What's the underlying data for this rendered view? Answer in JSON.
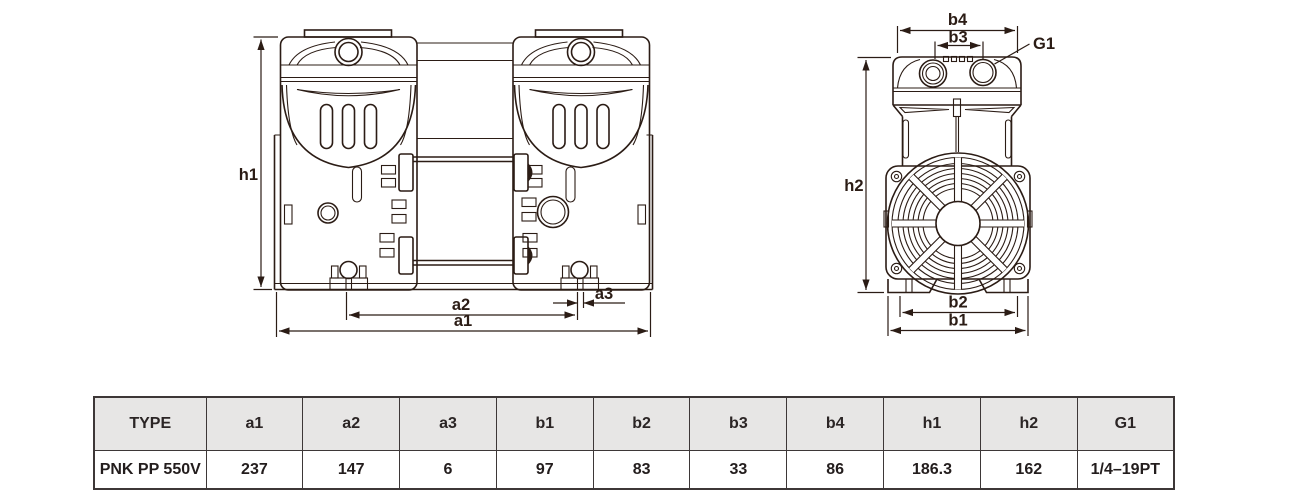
{
  "drawing": {
    "front_view": {
      "name": "pump-front-view",
      "labels": {
        "h1": "h1",
        "a1": "a1",
        "a2": "a2",
        "a3": "a3"
      }
    },
    "side_view": {
      "name": "pump-side-view",
      "labels": {
        "b1": "b1",
        "b2": "b2",
        "b3": "b3",
        "b4": "b4",
        "h2": "h2",
        "g1": "G1"
      }
    }
  },
  "table": {
    "headers": [
      "TYPE",
      "a1",
      "a2",
      "a3",
      "b1",
      "b2",
      "b3",
      "b4",
      "h1",
      "h2",
      "G1"
    ],
    "rows": [
      [
        "PNK PP 550V",
        "237",
        "147",
        "6",
        "97",
        "83",
        "33",
        "86",
        "186.3",
        "162",
        "1/4–19PT"
      ]
    ]
  },
  "colors": {
    "line": "#2b1c15",
    "table_border": "#3d3737",
    "header_bg": "#e7e6e5",
    "text": "#231d1d"
  }
}
